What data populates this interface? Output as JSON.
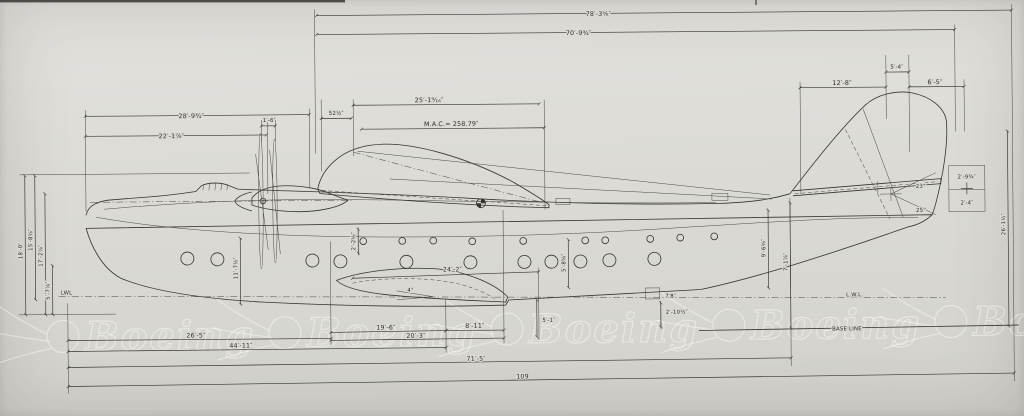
{
  "document": {
    "type": "engineering-drawing",
    "subject": "flying boat general arrangement - side elevation",
    "media": "scanned blueprint on gray paper"
  },
  "colors": {
    "paper": "#dcdbd6",
    "ink": "#35342f",
    "watermark": "#ffffff"
  },
  "watermark": {
    "text": "Boeing"
  },
  "reference": {
    "waterline_left": "LWL",
    "waterline_right": "L.W.L.",
    "baseline": "BASE LINE"
  },
  "dims": {
    "d78": "78′-3⅝″",
    "d70": "70′-9¾″",
    "d28": "28′-9¾″",
    "d22": "22′-1⅞″",
    "d1_6": "1′-6″",
    "d52": "52½″",
    "d25": "25′-1⁹⁄₁₆″",
    "dmac": "M.A.C.= 258.79″",
    "d5_4": "5′-4″",
    "d12_8": "12′-8″",
    "d6_5": "6′-5″",
    "d2_9": "2′-9¾″",
    "d2_4": "2′-4″",
    "a23": "23°",
    "a25": "25°",
    "d24_2": "24′-2″",
    "a4": "4°",
    "d11_7": "11′-7½″",
    "d2_2": "2′-2⅝″",
    "d5_8": "5′-8⅝″",
    "d5_1": "5′-1″",
    "d7_8": "7′8″",
    "d2_10": "2′-10½″",
    "d9_6": "9′-6⅝″",
    "d7_1": "7′-1⅞″",
    "d26_1": "26′-1½″",
    "d26_5": "26′-5″",
    "d44_11": "44′-11″",
    "d19_6": "19′-6″",
    "d20_3": "20′-3″",
    "d8_11": "8′-11″",
    "d71_5": "71′-5″",
    "d109": "109′",
    "lv18": "18′-0″",
    "lv15": "15′-8⅝″",
    "lv17": "17′-2⅞″",
    "lv5": "5′-7⅞″"
  }
}
